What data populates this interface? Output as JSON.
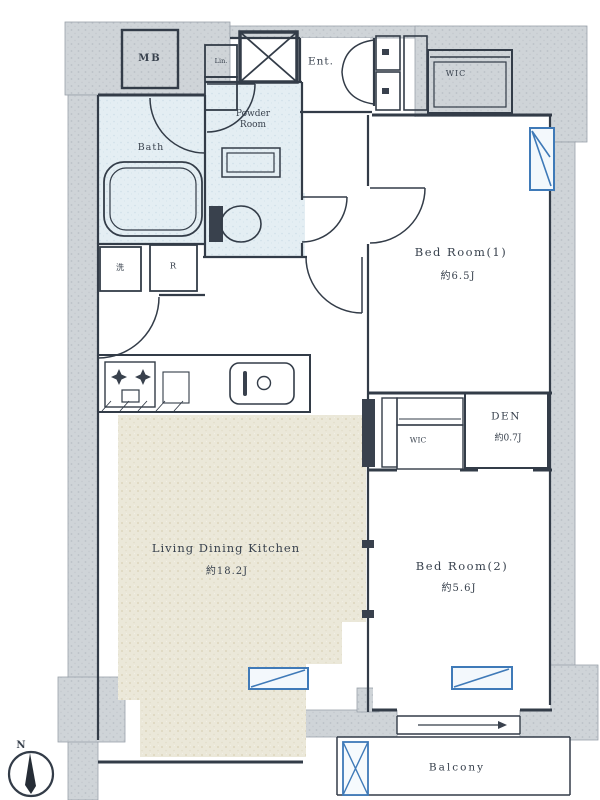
{
  "rooms": {
    "mb": "MB",
    "linen": "Lin.",
    "entrance": "Ent.",
    "wic_upper": "WIC",
    "powder_room": "Powder Room",
    "bath": "Bath",
    "bedroom1": "Bed Room(1)",
    "bedroom1_size": "約6.5J",
    "washer": "洗",
    "fridge": "R",
    "den": "DEN",
    "den_size": "約0.7J",
    "wic_mid": "WIC",
    "ldk": "Living Dining Kitchen",
    "ldk_size": "約18.2J",
    "bedroom2": "Bed Room(2)",
    "bedroom2_size": "約5.6J",
    "balcony": "Balcony"
  },
  "compass": {
    "north": "N"
  },
  "colors": {
    "line": "#333c48",
    "wall": "#cfd4d8",
    "room_blue": "#e4eef3",
    "floor_beige": "#ebe8d9",
    "window_blue": "#3f7ab8"
  }
}
